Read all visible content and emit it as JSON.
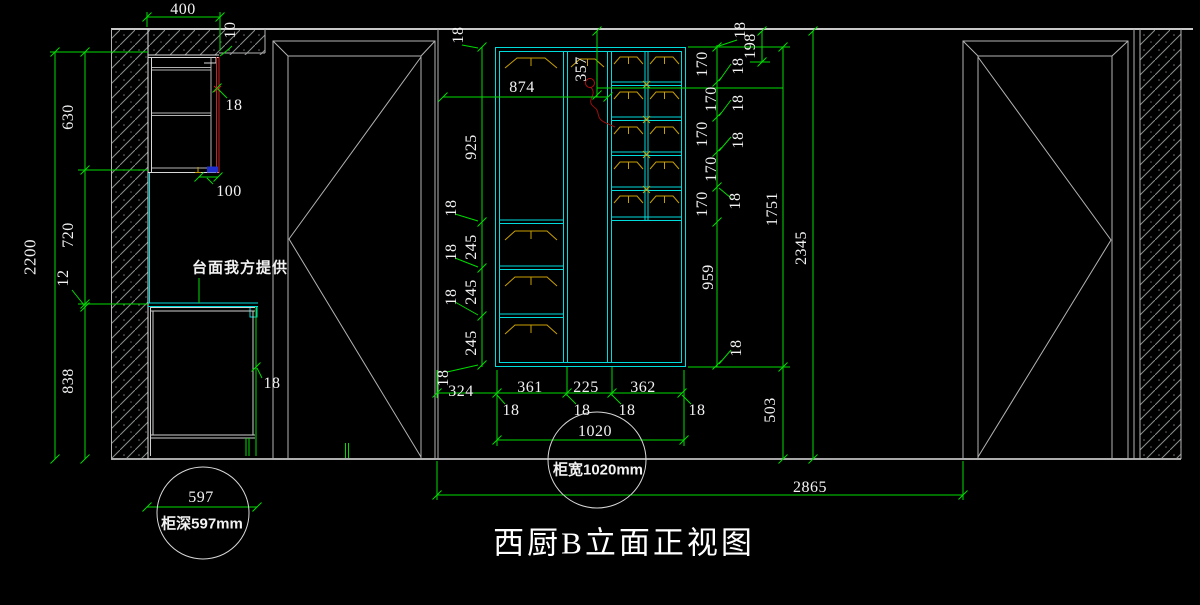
{
  "title": "西厨B立面正视图",
  "notes": {
    "countertop": "台面我方提供"
  },
  "callouts": {
    "cabinet_width": "柜宽1020mm",
    "cabinet_depth": "柜深597mm"
  },
  "dims": {
    "d400": "400",
    "d10": "10",
    "d18": "18",
    "d100": "100",
    "d2200": "2200",
    "d630": "630",
    "d720": "720",
    "d12": "12",
    "d838": "838",
    "d925": "925",
    "d245": "245",
    "d874": "874",
    "d357": "357",
    "d170": "170",
    "d959": "959",
    "d198": "198",
    "d1751": "1751",
    "d503": "503",
    "d2345": "2345",
    "d324": "324",
    "d361": "361",
    "d225": "225",
    "d362": "362",
    "d1020": "1020",
    "d2865": "2865",
    "d597": "597"
  },
  "colors": {
    "background": "#000000",
    "dimension": "#00dc00",
    "cabinet": "#00dcdc",
    "structure": "#b3b3b3",
    "hinge": "#c8a000",
    "accent_red": "#cc2222",
    "accent_blue": "#2030d0",
    "text": "#f2f2f2"
  }
}
